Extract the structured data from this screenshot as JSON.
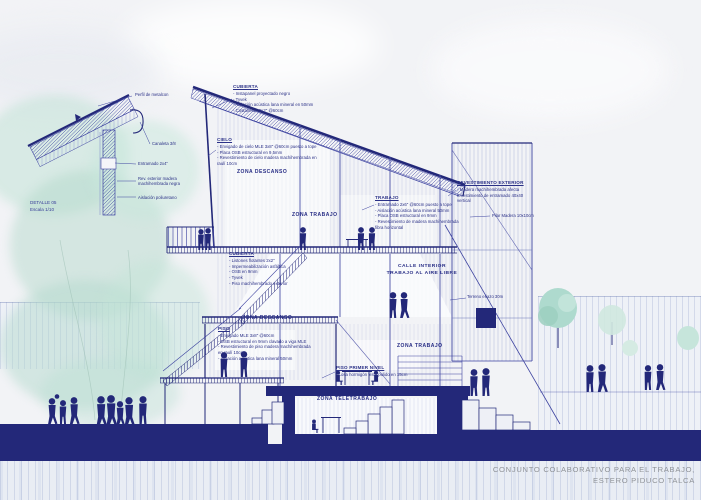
{
  "title": {
    "line1": "CONJUNTO COLABORATIVO PARA EL TRABAJO,",
    "line2": "ESTERO PIDUCO TALCA"
  },
  "detail_drawing": {
    "label": "DETALLE 05",
    "scale": "Escala 1/10",
    "callouts": [
      "Perfil de metalcon",
      "Canaleta 3/8",
      "Entramado 2x4\"",
      "Rev. exterior madera machihembrada negra",
      "Aislación poliuretano"
    ]
  },
  "annotation_blocks": {
    "cubierta": {
      "title": "CUBIERTA",
      "items": [
        "Instapanel proyectado negro",
        "Tyvek",
        "Aislación acústica lana mineral en 50mm",
        "Costaneras 2x2\" @60cm"
      ]
    },
    "cielo": {
      "title": "CIELO",
      "items": [
        "Envigado de cielo MLE 3x8\" @60cm puesto a tope",
        "Placa OSB estructural en 9,5mm",
        "Revestimiento de cielo madera machihembrada en raulí 10cm"
      ]
    },
    "trabajo": {
      "title": "TRABAJO",
      "items": [
        "Entramado 2x6\" @60cm puesto a tope",
        "Aislación acústica lana mineral 50mm",
        "Placa OSB estructural en 9mm",
        "Revestimiento de madera machihembrada fibra horizontal"
      ]
    },
    "revestimiento_exterior": {
      "title": "REVESTIMIENTO EXTERIOR",
      "items": [
        "Madera machihembrada afecta revestimiento de entramado 40x40 vertical",
        "Pilar Madera 10x10cm"
      ]
    },
    "terraza": {
      "title": "CUBIERTA",
      "items": [
        "Listones flotantes 2x2\"",
        "Impermeabilización asfáltica",
        "OSB en 9mm",
        "Tyvek",
        "Piso machihembrado exterior"
      ]
    },
    "piso": {
      "title": "PISO",
      "items": [
        "Envigado MLE 3x8\" @60cm",
        "OSB estructural en 9mm clavado a viga MLE",
        "Revestimiento de piso madera machihembrada en raulí 10cm",
        "Aislación acústica lana mineral 50mm"
      ]
    },
    "piso_primer_nivel": {
      "title": "PISO PRIMER NIVEL",
      "items": [
        "Losa hormigón visto pulido en 15cm"
      ]
    },
    "terreno": "Terreno eriazo 30m"
  },
  "zone_labels": {
    "descanso_sup": "ZONA DESCANSO",
    "trabajo_sup": "ZONA TRABAJO",
    "calle_l1": "CALLE INTERIOR",
    "calle_l2": "TRABAJO AL AIRE LIBRE",
    "descanso_inf": "ZONA DESCANSO",
    "trabajo_inf": "ZONA TRABAJO",
    "teletrabajo": "ZONA TELETRABAJO"
  },
  "colors": {
    "ink_navy": "#232879",
    "tree_teal": "#aedace",
    "title_grey": "#909398"
  }
}
